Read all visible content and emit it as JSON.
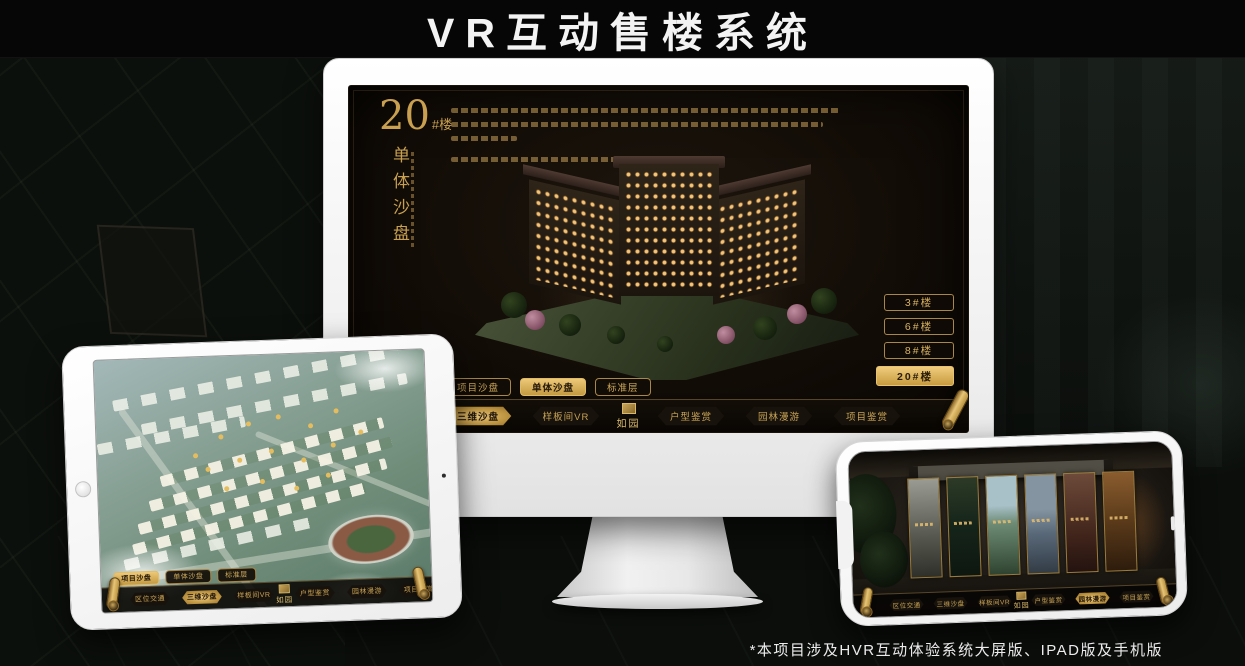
{
  "page": {
    "title": "VR互动售楼系统",
    "footnote": "*本项目涉及HVR互动体验系统大屏版、IPAD版及手机版"
  },
  "colors": {
    "gold": "#C9A45C",
    "gold_bright": "#E8C672",
    "gold_dark": "#8A6527",
    "screen_bg": "#16100A",
    "active_text": "#231709",
    "page_bg": "#0B0E0B",
    "title_text": "#F3F3F3"
  },
  "icons": {
    "scroll": "gold-scroll-icon",
    "seal": "brand-seal-icon",
    "home_button": "tablet-home-button-icon",
    "camera": "camera-dot-icon",
    "notch": "phone-notch"
  },
  "monitor_ui": {
    "heading": {
      "number": "20",
      "suffix": "#楼",
      "subtitle_vertical": "单体沙盘"
    },
    "floor_buttons": [
      {
        "label": "3#楼",
        "active": false
      },
      {
        "label": "6#楼",
        "active": false
      },
      {
        "label": "8#楼",
        "active": false
      },
      {
        "label": "20#楼",
        "active": true
      }
    ],
    "view_tabs": [
      {
        "label": "项目沙盘",
        "active": false
      },
      {
        "label": "单体沙盘",
        "active": true
      },
      {
        "label": "标准层",
        "active": false
      }
    ],
    "nav_left": [
      {
        "label": "区位交通",
        "active": false
      },
      {
        "label": "三维沙盘",
        "active": true
      },
      {
        "label": "样板间VR",
        "active": false
      }
    ],
    "nav_right": [
      {
        "label": "户型鉴赏",
        "active": false
      },
      {
        "label": "园林漫游",
        "active": false
      },
      {
        "label": "项目鉴赏",
        "active": false
      }
    ],
    "logo_text": "如园"
  },
  "tablet_ui": {
    "view_tabs": [
      {
        "label": "项目沙盘",
        "active": true
      },
      {
        "label": "单体沙盘",
        "active": false
      },
      {
        "label": "标准层",
        "active": false
      }
    ],
    "nav_left": [
      {
        "label": "区位交通",
        "active": false
      },
      {
        "label": "三维沙盘",
        "active": true
      },
      {
        "label": "样板间VR",
        "active": false
      }
    ],
    "nav_right": [
      {
        "label": "户型鉴赏",
        "active": false
      },
      {
        "label": "园林漫游",
        "active": false
      },
      {
        "label": "项目鉴赏",
        "active": false
      }
    ],
    "logo_text": "如园"
  },
  "phone_ui": {
    "nav_left": [
      {
        "label": "区位交通",
        "active": false
      },
      {
        "label": "三维沙盘",
        "active": false
      },
      {
        "label": "样板间VR",
        "active": false
      }
    ],
    "nav_right": [
      {
        "label": "户型鉴赏",
        "active": false
      },
      {
        "label": "园林漫游",
        "active": true
      },
      {
        "label": "项目鉴赏",
        "active": false
      }
    ],
    "logo_text": "如园"
  }
}
